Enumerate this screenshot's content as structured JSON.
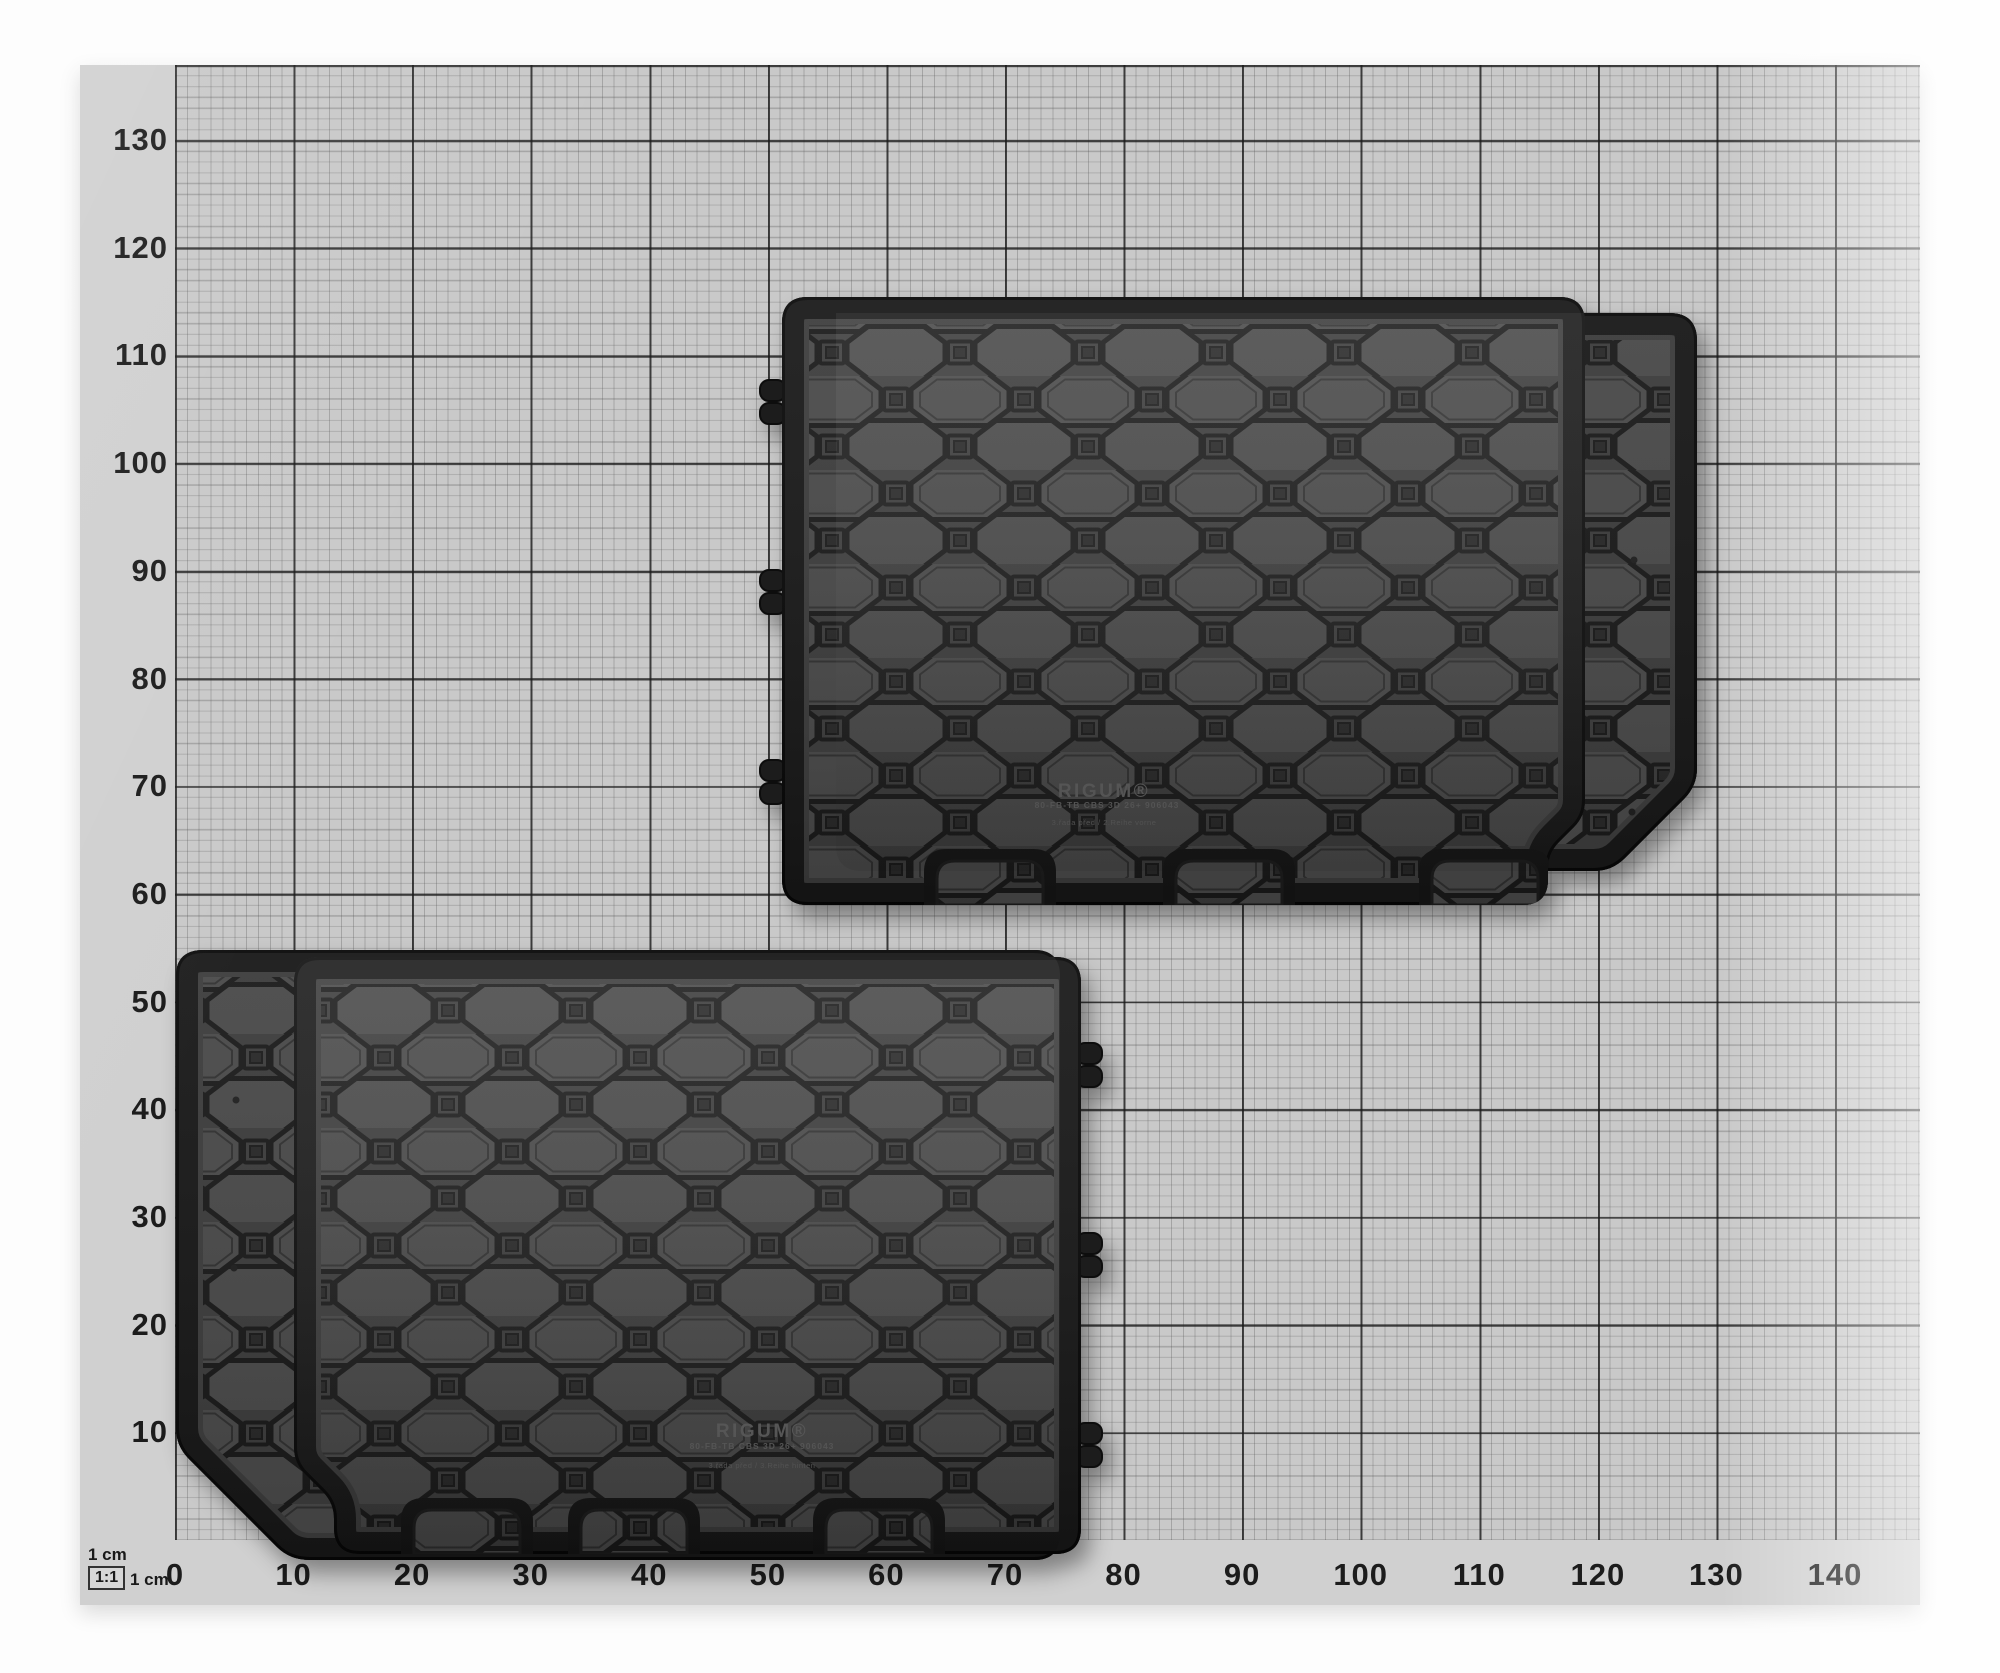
{
  "photo": {
    "subject": "two black rubber car trunk mats laid on 1 cm graph paper"
  },
  "scale": {
    "top_label": "1 cm",
    "ratio_label": "1:1",
    "ratio_side_label": "1 cm",
    "unit": "cm"
  },
  "y_axis": {
    "labels": [
      "130",
      "120",
      "110",
      "100",
      "90",
      "80",
      "70",
      "60",
      "50",
      "40",
      "30",
      "20",
      "10"
    ]
  },
  "x_axis": {
    "labels": [
      "0",
      "10",
      "20",
      "30",
      "40",
      "50",
      "60",
      "70",
      "80",
      "90",
      "100",
      "110",
      "120",
      "130",
      "140"
    ]
  },
  "mats": {
    "top_right": {
      "brand": "RIGUM®",
      "code": "80-FB-TB CBS 3D 26+ 906043",
      "variant": "3.řada před / 2.Reihe vorne"
    },
    "bottom_left": {
      "brand": "RIGUM®",
      "code": "80-FB-TB CBS 3D 26+ 906043",
      "variant": "3.řada před / 3.Reihe hinten"
    }
  },
  "colors": {
    "paper": "#d0d0d0",
    "grid_field": "#c9c9c9",
    "grid_bold": "#222222",
    "mat_base": "#3a3a3a",
    "mat_cell": "#474747",
    "mat_border": "#161616",
    "label_ink": "#1c1c1c"
  }
}
